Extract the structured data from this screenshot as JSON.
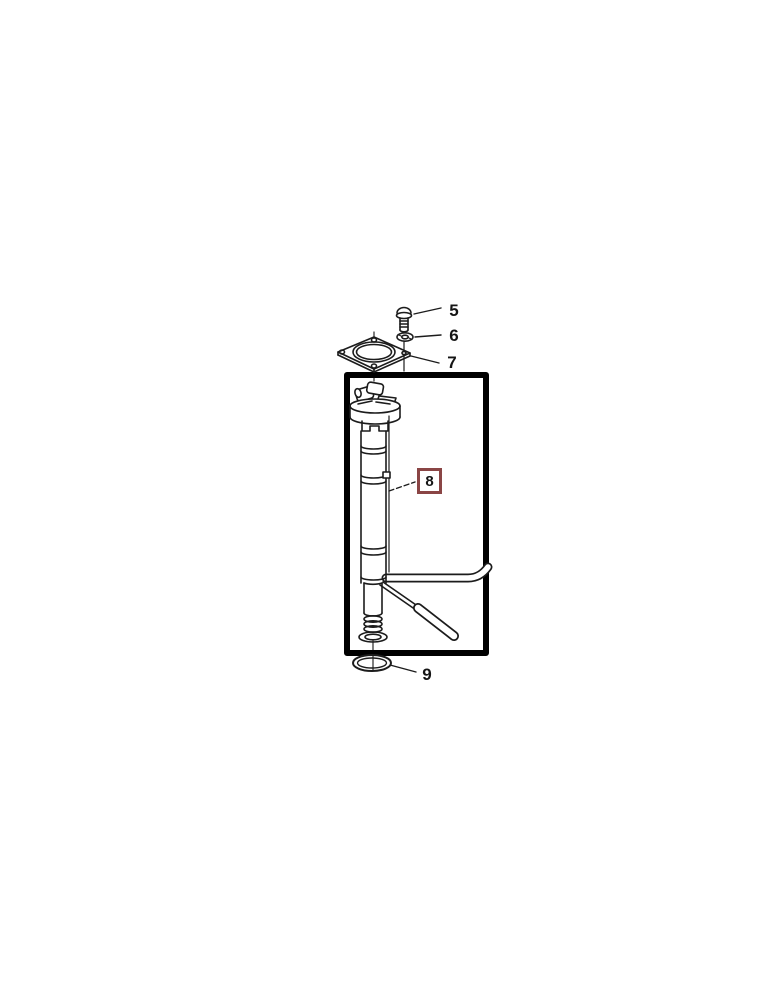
{
  "diagram": {
    "type": "exploded-parts-diagram",
    "callouts": {
      "part5": "5",
      "part6": "6",
      "part7": "7",
      "part8": "8",
      "part9": "9"
    },
    "highlighted_part": "8",
    "colors": {
      "line": "#1c1c1c",
      "frame": "#000000",
      "highlight_box_border": "#8a4545",
      "background": "#ffffff"
    }
  }
}
